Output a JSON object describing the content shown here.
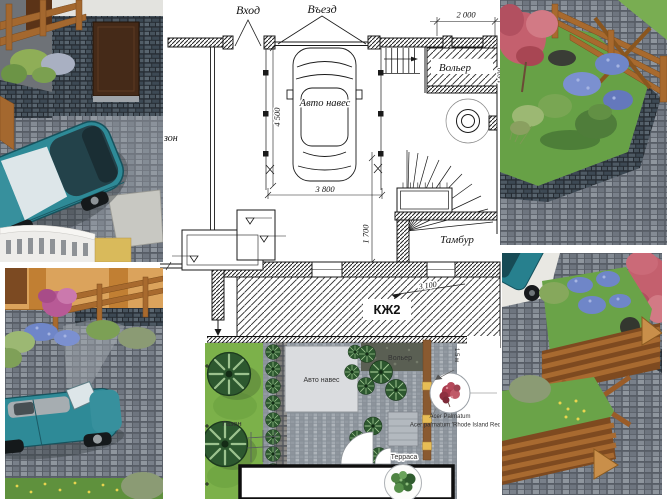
{
  "page": {
    "background": "#ffffff"
  },
  "floor_plan": {
    "labels": {
      "entrance": "Вход",
      "drive_in": "Въезд",
      "aviary": "Вольер",
      "car_canopy": "Авто навес",
      "vestibule": "Тамбур",
      "lawn_cropped": "зон",
      "building_mark": "КЖ2"
    },
    "dimensions": {
      "aviary_width": "2 000",
      "canopy_length": "4 500",
      "canopy_width": "3 800",
      "vestibule_depth": "1 700",
      "right_edge": "1 600",
      "building_span": "3 100"
    }
  },
  "site_plan": {
    "labels": {
      "lawn": "Газон",
      "car_canopy": "Авто навес",
      "aviary": "Вольер",
      "terrace": "Терраса"
    },
    "fence_height": "1.5 м",
    "plant_annotation": {
      "line1": "Acer Palmatum",
      "line2": "Acer palmatum 'Rhode Island Red'"
    }
  },
  "colors": {
    "car_teal": "#2e8a97",
    "lawn_green": "#6aa348",
    "paving_grey": "#858b93",
    "wood_brown": "#a4682f",
    "maple_red": "#c4606e",
    "flower_blue": "#6f86c8",
    "plan_line": "#1a1a1a"
  }
}
